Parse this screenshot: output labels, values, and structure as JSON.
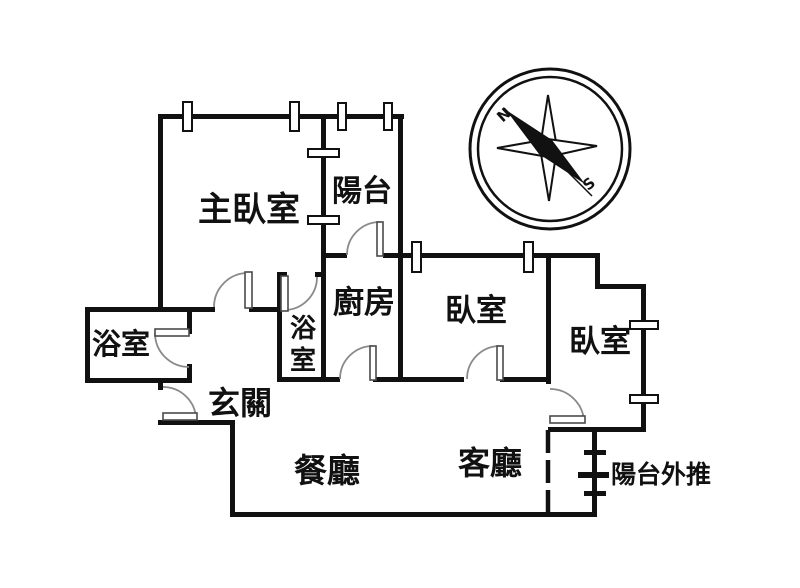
{
  "figure": {
    "kind": "apartment-floor-plan"
  },
  "rooms": {
    "master_bedroom": "主臥室",
    "balcony": "陽台",
    "kitchen": "廚房",
    "bathroom_left": "浴室",
    "bathroom_small_vertical": [
      "浴",
      "室"
    ],
    "entry": "玄關",
    "bedroom_middle": "臥室",
    "bedroom_right": "臥室",
    "dining": "餐廳",
    "living": "客廳",
    "balcony_extension": "陽台外推"
  },
  "compass": {
    "north_label": "N",
    "south_label": "S"
  },
  "colors": {
    "wall": "#111111",
    "background": "#ffffff",
    "door_arc": "#8a8a8a"
  }
}
